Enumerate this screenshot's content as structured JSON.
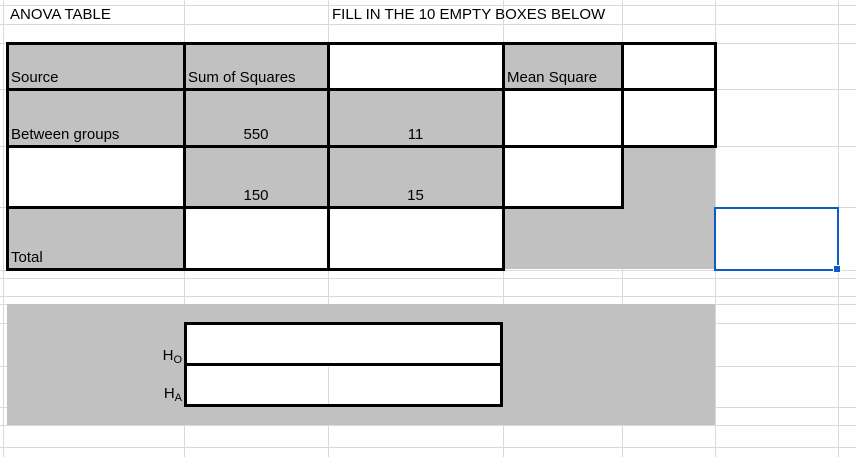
{
  "header": {
    "title": "ANOVA TABLE",
    "instruction": "FILL IN THE 10 EMPTY BOXES BELOW"
  },
  "anova_table": {
    "grid": [
      [
        "Source",
        "Sum of Squares",
        "",
        "Mean Square",
        ""
      ],
      [
        "Between groups",
        "550",
        "11",
        "",
        ""
      ],
      [
        "",
        "150",
        "15",
        "",
        ""
      ],
      [
        "Total",
        "",
        "",
        "",
        ""
      ]
    ]
  },
  "hypotheses": {
    "null": {
      "base": "H",
      "sub": "O"
    },
    "alternative": {
      "base": "H",
      "sub": "A"
    }
  },
  "colors": {
    "cell_fill_gray": "#c1c1c1",
    "gridline": "#d9d9d9",
    "table_border": "#000000",
    "selection_blue": "#0b5bcb"
  }
}
